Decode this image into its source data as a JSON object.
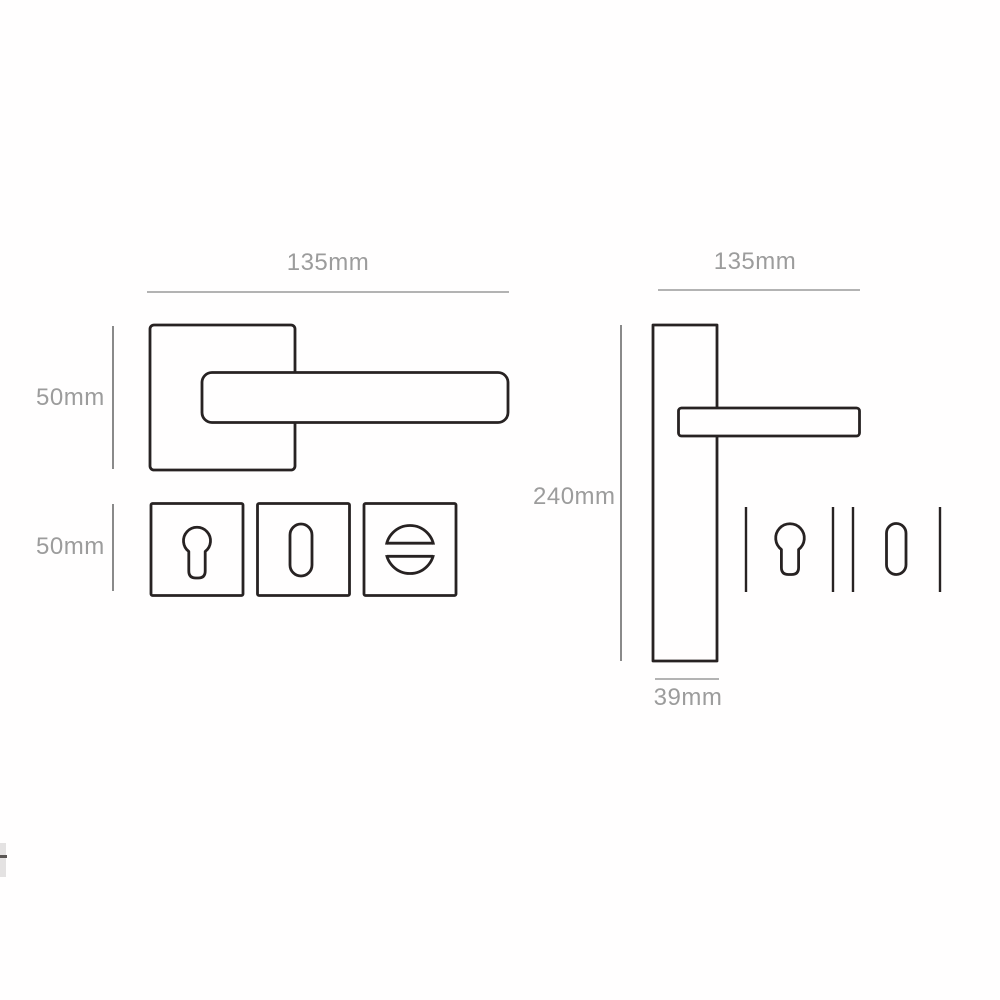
{
  "diagram": {
    "kind": "door-handle-technical-drawing",
    "left_view": {
      "width_dimension": "135mm",
      "handle_height_dimension": "50mm",
      "escutcheon_height_dimension": "50mm",
      "parts": [
        "square-rose-lever-handle",
        "euro-cylinder-escutcheon",
        "keyhole-escutcheon",
        "thumbturn-escutcheon"
      ]
    },
    "right_view": {
      "width_dimension": "135mm",
      "height_dimension": "240mm",
      "plate_width_dimension": "39mm",
      "parts": [
        "backplate-lever-handle",
        "euro-cylinder-cutout",
        "keyhole-cutout"
      ]
    }
  },
  "colors": {
    "object_line": "#272222",
    "dimension_line": "#9a9a9a",
    "dimension_line_dark": "#8a8a8a",
    "text": "#9c9c9c",
    "background": "#fffefe"
  }
}
